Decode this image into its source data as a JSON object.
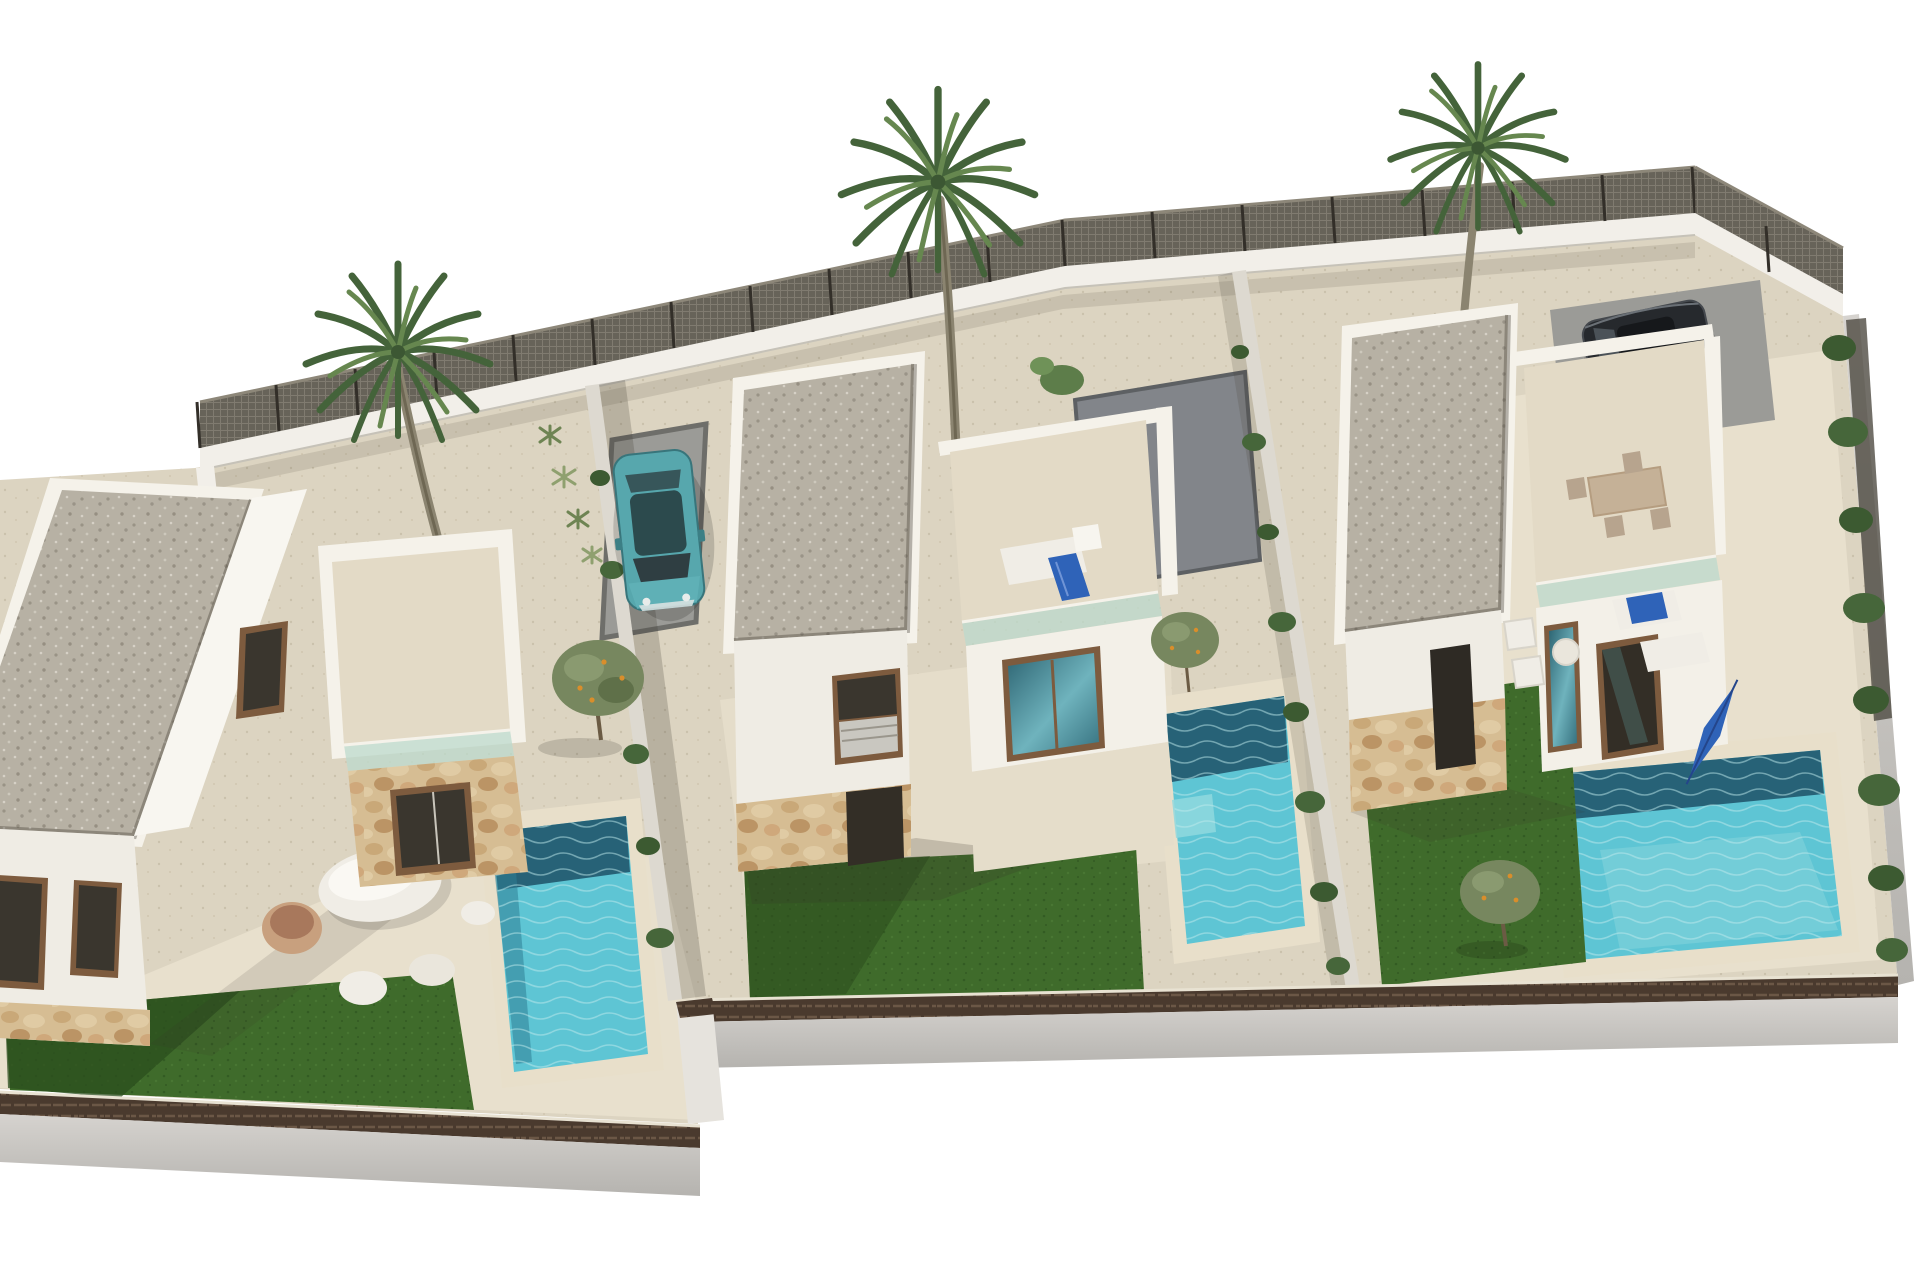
{
  "scene": {
    "type": "architectural-3d-render",
    "description": "Aerial cut-out 3D rendering of a residential development with three modern white flat-roof villas, each with gravel roof, roof terrace with glass balustrade, stone-clad accents, private turquoise pool, artificial lawn, beige gravel yards, perimeter walls with mesh fencing, three palm trees, olive trees, a teal parked car and a dark car.",
    "objects": [
      "left-villa",
      "middle-villa",
      "right-villa",
      "left-pool",
      "middle-pool",
      "right-pool",
      "left-lawn",
      "middle-lawn",
      "right-lawn",
      "palm-tree-left",
      "palm-tree-middle",
      "palm-tree-right",
      "teal-car",
      "dark-car",
      "pebble-lounge-set",
      "roof-lounger-with-blue-towel",
      "roof-dining-set",
      "garden-furniture-set",
      "closed-blue-parasol",
      "olive-trees",
      "perimeter-mesh-fence",
      "front-boundary-walls"
    ]
  },
  "colors": {
    "background": "#ffffff",
    "ground": "#dcd4c1",
    "ground_light": "#e8e0cd",
    "pavement": "#e5ddca",
    "lawn": "#3f6b2b",
    "lawn_shadow": "#2b4d1e",
    "pool_water": "#5ec5d4",
    "pool_deep": "#21576d",
    "pool_shelf": "#8fd8de",
    "pool_coping": "#e8dfca",
    "roof_gravel": "#b7b1a4",
    "parapet": "#f5f2ea",
    "wall_white": "#f3f0e8",
    "wall_front": "#efece4",
    "wall_side": "#f8f6f0",
    "wall_shade": "#d9d5cb",
    "stone": "#d6bd93",
    "fence_mesh": "#5a554b",
    "fence_post": "#332f29",
    "fence_rail": "#8d8779",
    "boundary_wall": "#f2efe9",
    "coping_brick": "#4a3a2e",
    "outer_wall": "#d6d3cf",
    "outer_wall_dark": "#b5b3af",
    "driveway": "#9b9b97",
    "driveway_border": "#6e6e6a",
    "pad": "#82858a",
    "car_teal": "#57a7ad",
    "car_teal_roof": "#2c4a4d",
    "car_glass": "#2f3e42",
    "car_dark": "#26292d",
    "olive": "#77875f",
    "olive_fruit": "#d98e2b",
    "shrub": "#3c5a31",
    "agave": "#8fa06f",
    "palm_dark": "#44633a",
    "palm_light": "#66874f",
    "palm_trunk": "#8b8470",
    "furniture_white": "#f0ede6",
    "furniture_tan": "#c5b197",
    "towel_blue": "#2f63b8",
    "balustrade": "#bcd9cc",
    "window_frame": "#7d5b3e",
    "window_glass": "#3a362e",
    "shadow": "rgba(55,50,40,0.20)"
  }
}
